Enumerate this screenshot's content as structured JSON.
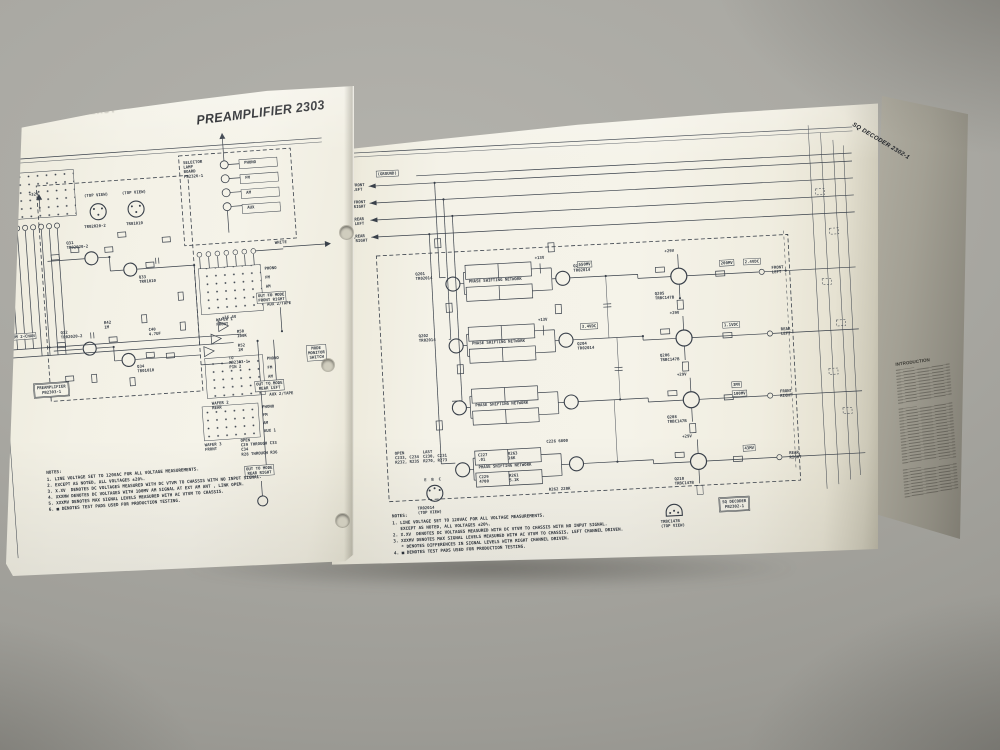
{
  "photo": {
    "description": "Open service-manual fold-out photographed on a gray surface showing two circuit schematic pages",
    "backdrop_color": "#a9a8a2",
    "paper_color": "#f2f0e5",
    "ink_color": "#39404a"
  },
  "left_page": {
    "title": "PREAMPLIFIER 2303",
    "show_through": "TUNER ALIGNMENT",
    "wafers": [
      "WAFER 1\nFRONT",
      "WAFER 2\nREAR",
      "WAFER 3\nFRONT"
    ],
    "switch_positions": [
      "PHONO",
      "FM",
      "AM",
      "AUX 1",
      "AUX 2/TAPE"
    ],
    "selector_board_label": "SELECTOR\nLAMP\nBOARD\nPB2326-1",
    "lamp_labels": [
      "PHONO",
      "FM",
      "AM",
      "AUX"
    ],
    "wire_label": "WHITE",
    "rail_32": "+32V",
    "rail_164": "+16.4V",
    "top_view": "(TOP VIEW)",
    "top_view_parts": [
      "TR02020-2",
      "TR01010"
    ],
    "transistors": [
      "Q31\nTR02020-2",
      "Q33\nTR01010",
      "Q32\nTR02020-2",
      "Q34\nTR01010"
    ],
    "board_label": "PREAMPLIFIER\nPB2303-1",
    "out_boxes": [
      "OUT TO MODE\nFRONT RIGHT",
      "OUT TO MODE\nREAR LEFT",
      "OUT TO MODE\nREAR RIGHT"
    ],
    "to_pin_label": "TO\nPB2303-1\nPIN 2",
    "components": [
      "R50\n100K",
      "R52\n1M",
      "C40\n4.7UF",
      "R42\n1M"
    ],
    "from_label": "FROM 2-CHAN",
    "mode_switch_label": "MODE\nMONITOR\nSWITCH",
    "open_note": "OPEN\nC29 THROUGH C33\nC34\nR28 THROUGH R36",
    "notes_title": "NOTES:",
    "notes": [
      "1. LINE VOLTAGE SET TO 120VAC FOR ALL VOLTAGE MEASUREMENTS.",
      "2. EXCEPT AS NOTED, ALL VOLTAGES ±20%.",
      "3. X.XV  DENOTES DC VOLTAGES MEASURED WITH DC VTVM TO CHASSIS WITH NO INPUT SIGNAL.",
      "4. XXXMW DENOTES DC VOLTAGES WITH 100MV AM SIGNAL AT EXT AM ANT , LINK OPEN.",
      "5. XXXMV DENOTES MAX SIGNAL LEVELS MEASURED WITH AC VTVM TO CHASSIS.",
      "6. ■ DENOTES TEST PADS USED FOR PRODUCTION TESTING."
    ]
  },
  "main_page": {
    "show_through": "CONTROL AMPLIFIER 2304-1",
    "input_group_label": "FROM\nCONTROL\nAMPLIFIER",
    "inputs": [
      "FRONT\nLEFT",
      "FRONT\nRIGHT",
      "REAR\nLEFT",
      "REAR\nRIGHT"
    ],
    "ground_label": "(GROUND)",
    "network_label": "PHASE SHIFTING NETWORK",
    "rail_29": "+29V",
    "rail_13": "+13V",
    "mid_transistors": [
      "Q201\nTR02014",
      "Q202\nTR02014",
      "Q203\nTR02014",
      "Q204\nTR02014"
    ],
    "out_transistors": [
      "Q205\nTRBC147B",
      "Q206\nTRBC147B",
      "Q208\nTRBC147B",
      "Q210\nTRBC147B"
    ],
    "outputs": [
      "FRONT\nLEFT",
      "REAR\nLEFT",
      "FRONT\nRIGHT",
      "REAR\nRIGHT"
    ],
    "callouts": [
      "550MV",
      "3.4VDC",
      "200MV",
      "2.4VDC",
      "1.1VDC",
      "3MV",
      "100MV",
      "43MV"
    ],
    "net4_components": [
      "C227\n.01",
      "R263\n16K",
      "C229\n4700",
      "R261\n5.1K",
      "C226 6800",
      "R262 220K"
    ],
    "open_note": "OPEN\nC233, C234\nR232, R235",
    "last_note": "LAST\nC230, C231\nR270, R273",
    "tv1_pins": "E  B  C",
    "tv1_label": "TR02014\n(TOP VIEW)",
    "tv2_label": "TRBC147B\n(TOP VIEW)",
    "board_label": "SQ DECODER\nPB2302-1",
    "notes_title": "NOTES:",
    "notes": [
      "1. LINE VOLTAGE SET TO 120VAC FOR ALL VOLTAGE MEASUREMENTS.",
      "   EXCEPT AS NOTED, ALL VOLTAGES ±20%.",
      "2. X.XV  DENOTES DC VOLTAGES MEASURED WITH DC VTVM TO CHASSIS WITH NO INPUT SIGNAL.",
      "3. XXXMV DENOTES MAX SIGNAL LEVELS MEASURED WITH AC VTVM TO CHASSIS, LEFT CHANNEL DRIVEN.",
      "   * DENOTES DIFFERENCES IN SIGNAL LEVELS WITH RIGHT CHANNEL DRIVEN.",
      "4. ■ DENOTES TEST PADS USED FOR PRODUCTION TESTING."
    ]
  },
  "fold_panel": {
    "spine_title": "SQ DECODER 2302-1",
    "intro_title": "INTRODUCTION"
  }
}
